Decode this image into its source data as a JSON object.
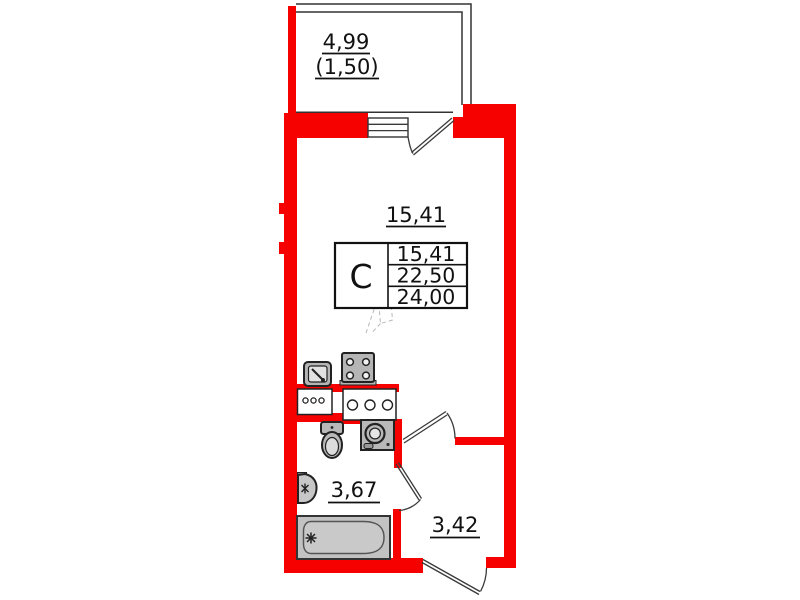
{
  "colors": {
    "wall": "#f70000",
    "line": "#333333",
    "fixture_fill": "#b9b9b9",
    "text": "#111111"
  },
  "labels": {
    "balcony_area": "4,99",
    "balcony_area_reduced": "(1,50)",
    "living_area": "15,41",
    "bathroom_area": "3,67",
    "hallway_area": "3,42"
  },
  "stamp": {
    "type_letter": "С",
    "rows": [
      "15,41",
      "22,50",
      "24,00"
    ]
  }
}
